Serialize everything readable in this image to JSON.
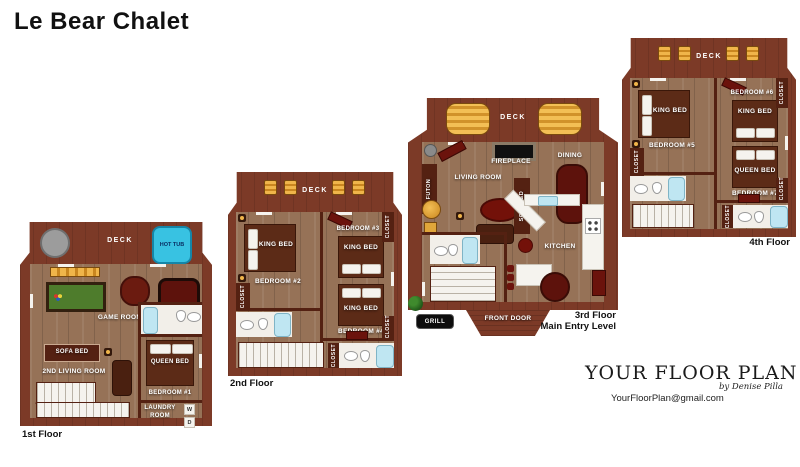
{
  "title": "Le Bear Chalet",
  "common": {
    "deck": "DECK",
    "king_bed": "KING BED",
    "queen_bed": "QUEEN BED",
    "sofa_bed": "SOFA BED",
    "closet": "CLOSET"
  },
  "floor1": {
    "name": "1st Floor",
    "hot_tub": "HOT TUB",
    "game_room": "GAME ROOM",
    "second_living": "2ND LIVING ROOM",
    "bedroom1": "BEDROOM #1",
    "laundry": "LAUNDRY ROOM",
    "washer": "W",
    "dryer": "D"
  },
  "floor2": {
    "name": "2nd Floor",
    "bedroom2": "BEDROOM #2",
    "bedroom3": "BEDROOM #3",
    "bedroom4": "BEDROOM #4"
  },
  "floor3": {
    "name_line1": "3rd Floor",
    "name_line2": "Main Entry Level",
    "living_room": "LIVING ROOM",
    "dining": "DINING",
    "kitchen": "KITCHEN",
    "fireplace": "FIREPLACE",
    "futon": "FUTON",
    "front_door": "FRONT DOOR",
    "grill": "GRILL"
  },
  "floor4": {
    "name": "4th Floor",
    "bedroom5": "BEDROOM #5",
    "bedroom6": "BEDROOM #6",
    "bedroom7": "BEDROOM #7"
  },
  "logo": {
    "brand": "YOUR FLOOR PLAN",
    "byline": "by Denise Pilla",
    "email": "YourFloorPlan@gmail.com"
  },
  "colors": {
    "deck": "#7c3a27",
    "wall": "#542112",
    "wood_floor": "#967257",
    "hot_tub": "#38c2e2",
    "bed": "#5c2b17",
    "pool_table": "#4e7c2c",
    "accent_gold": "#f0b54a",
    "accent_red": "#731109"
  }
}
